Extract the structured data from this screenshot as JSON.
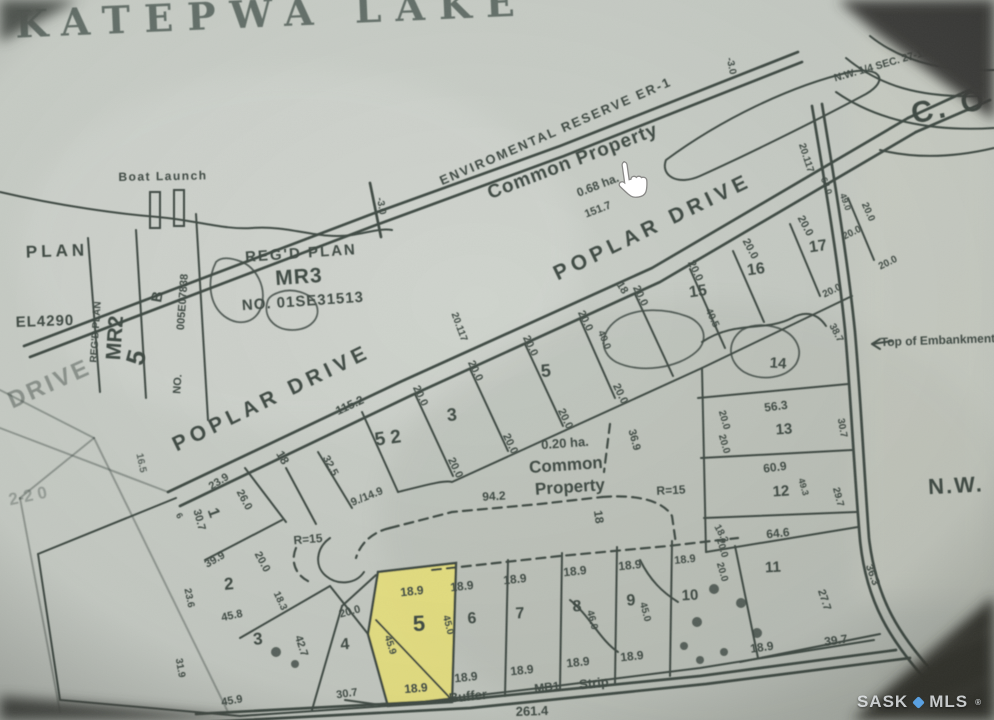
{
  "title": "KATEPWA LAKE",
  "watermark": {
    "left": "SASK",
    "right": "MLS",
    "reg": "®",
    "dot_color": "#5aa0e0"
  },
  "colors": {
    "paper_light": "#d0d5ce",
    "paper_dark": "#c2c7bf",
    "ink": "#404b45",
    "ink_faint": "#6b746d",
    "title_ink": "#4d5c54",
    "highlight_yellow": "#efe678",
    "corner_shadow": "#3b3d38",
    "cursor_fill": "#ffffff",
    "cursor_stroke": "#8a8a88"
  },
  "cursor": {
    "type": "hand-pointer",
    "x": 608,
    "y": 163
  },
  "labels": [
    {
      "t": "KATEPWA LAKE",
      "x": 272,
      "y": 17,
      "r": -2.5,
      "s": 38,
      "ls": 14,
      "f": "serif",
      "o": 0.8,
      "c": "#4d5c54"
    },
    {
      "t": "N.W. 1/4 SEC. 27-19-12-2",
      "x": 893,
      "y": 62,
      "r": -16,
      "s": 10.5
    },
    {
      "t": "C. O",
      "x": 950,
      "y": 108,
      "r": -12,
      "s": 30,
      "ls": 4
    },
    {
      "t": "-3.0",
      "x": 731,
      "y": 66,
      "r": 78,
      "s": 10
    },
    {
      "t": "20.117",
      "x": 806,
      "y": 158,
      "r": 72,
      "s": 10
    },
    {
      "t": "64.0",
      "x": 826,
      "y": 186,
      "r": 70,
      "s": 9
    },
    {
      "t": "49.0",
      "x": 845,
      "y": 202,
      "r": 70,
      "s": 9
    },
    {
      "t": "ENVIROMENTAL RESERVE ER-1",
      "x": 556,
      "y": 132,
      "r": -23.5,
      "s": 13,
      "ls": 2
    },
    {
      "t": "Common Property",
      "x": 573,
      "y": 162,
      "r": -21,
      "s": 19,
      "ls": 1
    },
    {
      "t": "0.68 ha.",
      "x": 598,
      "y": 186,
      "r": -21,
      "s": 12
    },
    {
      "t": "151.7",
      "x": 598,
      "y": 210,
      "r": -21,
      "s": 11
    },
    {
      "t": "-3.0",
      "x": 381,
      "y": 206,
      "r": 80,
      "s": 10
    },
    {
      "t": "POPLAR  DRIVE",
      "x": 272,
      "y": 399,
      "r": -26,
      "s": 21,
      "ls": 5
    },
    {
      "t": "115.2",
      "x": 350,
      "y": 406,
      "r": -25,
      "s": 12
    },
    {
      "t": "POPLAR  DRIVE",
      "x": 653,
      "y": 228,
      "r": -26,
      "s": 21,
      "ls": 5
    },
    {
      "t": "5 2",
      "x": 388,
      "y": 439,
      "r": -8,
      "s": 19
    },
    {
      "t": "3",
      "x": 452,
      "y": 416,
      "r": -5,
      "s": 18
    },
    {
      "t": "5",
      "x": 546,
      "y": 372,
      "r": -5,
      "s": 18
    },
    {
      "t": "15",
      "x": 698,
      "y": 292,
      "r": -8,
      "s": 16
    },
    {
      "t": "16",
      "x": 756,
      "y": 270,
      "r": -8,
      "s": 16
    },
    {
      "t": "17",
      "x": 818,
      "y": 247,
      "r": -8,
      "s": 16
    },
    {
      "t": "18",
      "x": 282,
      "y": 458,
      "r": 60,
      "s": 12
    },
    {
      "t": "32.5",
      "x": 330,
      "y": 466,
      "r": 62,
      "s": 11
    },
    {
      "t": "9./14.9",
      "x": 367,
      "y": 497,
      "r": -22,
      "s": 11
    },
    {
      "t": "20.117",
      "x": 459,
      "y": 327,
      "r": 70,
      "s": 10
    },
    {
      "t": "18",
      "x": 622,
      "y": 288,
      "r": 58,
      "s": 11
    },
    {
      "t": "18",
      "x": 598,
      "y": 517,
      "r": 82,
      "s": 12
    },
    {
      "t": "40.0",
      "x": 604,
      "y": 340,
      "r": 68,
      "s": 10
    },
    {
      "t": "40.5",
      "x": 712,
      "y": 318,
      "r": 65,
      "s": 10
    },
    {
      "t": "20.0",
      "x": 420,
      "y": 396,
      "r": 64,
      "s": 11
    },
    {
      "t": "20.0",
      "x": 475,
      "y": 371,
      "r": 64,
      "s": 11
    },
    {
      "t": "20.0",
      "x": 530,
      "y": 346,
      "r": 64,
      "s": 11
    },
    {
      "t": "20.0",
      "x": 585,
      "y": 321,
      "r": 64,
      "s": 11
    },
    {
      "t": "20.0",
      "x": 640,
      "y": 296,
      "r": 64,
      "s": 11
    },
    {
      "t": "20.0",
      "x": 695,
      "y": 271,
      "r": 64,
      "s": 11
    },
    {
      "t": "20.0",
      "x": 750,
      "y": 249,
      "r": 62,
      "s": 11
    },
    {
      "t": "20.0",
      "x": 805,
      "y": 226,
      "r": 62,
      "s": 11
    },
    {
      "t": "20.0",
      "x": 455,
      "y": 468,
      "r": 64,
      "s": 11
    },
    {
      "t": "20.0",
      "x": 510,
      "y": 444,
      "r": 64,
      "s": 11
    },
    {
      "t": "20.0",
      "x": 565,
      "y": 419,
      "r": 64,
      "s": 11
    },
    {
      "t": "20.0",
      "x": 620,
      "y": 394,
      "r": 64,
      "s": 11
    },
    {
      "t": "20.0",
      "x": 724,
      "y": 420,
      "r": 74,
      "s": 10
    },
    {
      "t": "20.0",
      "x": 724,
      "y": 444,
      "r": 74,
      "s": 10
    },
    {
      "t": "20.0",
      "x": 722,
      "y": 548,
      "r": 74,
      "s": 10
    },
    {
      "t": "20.0",
      "x": 722,
      "y": 572,
      "r": 74,
      "s": 10
    },
    {
      "t": "20.0",
      "x": 868,
      "y": 212,
      "r": 66,
      "s": 10
    },
    {
      "t": "20.0",
      "x": 852,
      "y": 233,
      "r": -26,
      "s": 10
    },
    {
      "t": "20.0",
      "x": 888,
      "y": 263,
      "r": -26,
      "s": 10
    },
    {
      "t": "20.0",
      "x": 832,
      "y": 291,
      "r": -26,
      "s": 10
    },
    {
      "t": "0.20 ha.",
      "x": 565,
      "y": 444,
      "r": -4,
      "s": 13
    },
    {
      "t": "Common",
      "x": 566,
      "y": 466,
      "r": -4,
      "s": 17
    },
    {
      "t": "Property",
      "x": 570,
      "y": 488,
      "r": -4,
      "s": 17
    },
    {
      "t": "94.2",
      "x": 494,
      "y": 497,
      "r": -3,
      "s": 12
    },
    {
      "t": "36.9",
      "x": 634,
      "y": 440,
      "r": 75,
      "s": 11
    },
    {
      "t": "R=15",
      "x": 671,
      "y": 491,
      "r": -3,
      "s": 12
    },
    {
      "t": "R=15",
      "x": 308,
      "y": 540,
      "r": -5,
      "s": 12
    },
    {
      "t": "14",
      "x": 778,
      "y": 364,
      "r": 4,
      "s": 15
    },
    {
      "t": "56.3",
      "x": 776,
      "y": 407,
      "r": -7,
      "s": 12
    },
    {
      "t": "13",
      "x": 784,
      "y": 430,
      "r": -4,
      "s": 15
    },
    {
      "t": "60.9",
      "x": 775,
      "y": 468,
      "r": -7,
      "s": 12
    },
    {
      "t": "12",
      "x": 781,
      "y": 492,
      "r": -4,
      "s": 15
    },
    {
      "t": "49.3",
      "x": 803,
      "y": 487,
      "r": 74,
      "s": 9
    },
    {
      "t": "64.6",
      "x": 778,
      "y": 534,
      "r": -6,
      "s": 12
    },
    {
      "t": "30.7",
      "x": 842,
      "y": 428,
      "r": 80,
      "s": 10
    },
    {
      "t": "38.7",
      "x": 836,
      "y": 333,
      "r": 62,
      "s": 10
    },
    {
      "t": "Top of Embankment",
      "x": 938,
      "y": 341,
      "r": -2,
      "s": 12
    },
    {
      "t": "N.W.",
      "x": 956,
      "y": 487,
      "r": -3,
      "s": 22,
      "ls": 2
    },
    {
      "t": "29.7",
      "x": 838,
      "y": 497,
      "r": 75,
      "s": 10
    },
    {
      "t": "27.7",
      "x": 824,
      "y": 600,
      "r": 72,
      "s": 11
    },
    {
      "t": "36.3",
      "x": 872,
      "y": 575,
      "r": 70,
      "s": 11
    },
    {
      "t": "18.3",
      "x": 721,
      "y": 534,
      "r": 62,
      "s": 10
    },
    {
      "t": "1",
      "x": 213,
      "y": 513,
      "r": 70,
      "s": 16
    },
    {
      "t": "23.9",
      "x": 219,
      "y": 482,
      "r": -32,
      "s": 11
    },
    {
      "t": "26.0",
      "x": 244,
      "y": 500,
      "r": 62,
      "s": 11
    },
    {
      "t": "30.7",
      "x": 199,
      "y": 520,
      "r": 75,
      "s": 11
    },
    {
      "t": "6",
      "x": 179,
      "y": 516,
      "r": 60,
      "s": 9
    },
    {
      "t": "39.9",
      "x": 215,
      "y": 560,
      "r": -30,
      "s": 11
    },
    {
      "t": "20.0",
      "x": 262,
      "y": 562,
      "r": 62,
      "s": 11
    },
    {
      "t": "2",
      "x": 229,
      "y": 585,
      "r": -5,
      "s": 17
    },
    {
      "t": "23.6",
      "x": 189,
      "y": 598,
      "r": 78,
      "s": 10
    },
    {
      "t": "45.8",
      "x": 232,
      "y": 616,
      "r": -12,
      "s": 11
    },
    {
      "t": "18.3",
      "x": 280,
      "y": 601,
      "r": 65,
      "s": 10
    },
    {
      "t": "3",
      "x": 258,
      "y": 640,
      "r": -5,
      "s": 17
    },
    {
      "t": "31.9",
      "x": 180,
      "y": 668,
      "r": 80,
      "s": 10
    },
    {
      "t": "42.7",
      "x": 301,
      "y": 646,
      "r": 72,
      "s": 11
    },
    {
      "t": "45.9",
      "x": 232,
      "y": 701,
      "r": -10,
      "s": 11
    },
    {
      "t": "4",
      "x": 345,
      "y": 645,
      "r": -5,
      "s": 16
    },
    {
      "t": "20.0",
      "x": 350,
      "y": 612,
      "r": -15,
      "s": 11
    },
    {
      "t": "30.7",
      "x": 347,
      "y": 694,
      "r": -8,
      "s": 11
    },
    {
      "t": "18.9",
      "x": 412,
      "y": 592,
      "r": -6,
      "s": 12
    },
    {
      "t": "5",
      "x": 419,
      "y": 625,
      "r": -3,
      "s": 22
    },
    {
      "t": "45.9",
      "x": 390,
      "y": 645,
      "r": 72,
      "s": 10
    },
    {
      "t": "18.9",
      "x": 416,
      "y": 689,
      "r": -5,
      "s": 12
    },
    {
      "t": "18.9",
      "x": 462,
      "y": 587,
      "r": -6,
      "s": 12
    },
    {
      "t": "45.0",
      "x": 448,
      "y": 625,
      "r": 75,
      "s": 10
    },
    {
      "t": "6",
      "x": 472,
      "y": 619,
      "r": -3,
      "s": 16
    },
    {
      "t": "18.9",
      "x": 466,
      "y": 678,
      "r": -6,
      "s": 12
    },
    {
      "t": "18.9",
      "x": 515,
      "y": 580,
      "r": -6,
      "s": 12
    },
    {
      "t": "7",
      "x": 520,
      "y": 614,
      "r": -3,
      "s": 16
    },
    {
      "t": "18.9",
      "x": 522,
      "y": 671,
      "r": -6,
      "s": 12
    },
    {
      "t": "18.9",
      "x": 575,
      "y": 572,
      "r": -6,
      "s": 12
    },
    {
      "t": "8",
      "x": 577,
      "y": 607,
      "r": -3,
      "s": 16
    },
    {
      "t": "46.0",
      "x": 592,
      "y": 620,
      "r": 75,
      "s": 10
    },
    {
      "t": "18.9",
      "x": 578,
      "y": 663,
      "r": -6,
      "s": 12
    },
    {
      "t": "18.9",
      "x": 630,
      "y": 566,
      "r": -6,
      "s": 12
    },
    {
      "t": "9",
      "x": 631,
      "y": 601,
      "r": -3,
      "s": 16
    },
    {
      "t": "45.0",
      "x": 645,
      "y": 612,
      "r": 75,
      "s": 10
    },
    {
      "t": "18.9",
      "x": 632,
      "y": 657,
      "r": -6,
      "s": 12
    },
    {
      "t": "18.9",
      "x": 685,
      "y": 560,
      "r": -6,
      "s": 11
    },
    {
      "t": "10",
      "x": 690,
      "y": 596,
      "r": -3,
      "s": 15
    },
    {
      "t": "18.9",
      "x": 762,
      "y": 648,
      "r": -8,
      "s": 12
    },
    {
      "t": "11",
      "x": 773,
      "y": 568,
      "r": -3,
      "s": 15
    },
    {
      "t": "39.7",
      "x": 836,
      "y": 641,
      "r": -8,
      "s": 12
    },
    {
      "t": "Buffer",
      "x": 468,
      "y": 697,
      "r": -6,
      "s": 13
    },
    {
      "t": "MB1",
      "x": 547,
      "y": 688,
      "r": -6,
      "s": 12
    },
    {
      "t": "Strip",
      "x": 594,
      "y": 684,
      "r": -6,
      "s": 13
    },
    {
      "t": "261.4",
      "x": 532,
      "y": 712,
      "r": -2,
      "s": 13
    },
    {
      "t": "Boat Launch",
      "x": 163,
      "y": 177,
      "r": -1,
      "s": 12,
      "ls": 1.5
    },
    {
      "t": "PLAN",
      "x": 57,
      "y": 252,
      "r": -2,
      "s": 17,
      "ls": 4
    },
    {
      "t": "EL4290",
      "x": 45,
      "y": 322,
      "r": -2,
      "s": 15,
      "ls": 1
    },
    {
      "t": "REG'D PLAN",
      "x": 96,
      "y": 332,
      "r": -86,
      "s": 10
    },
    {
      "t": "MR2",
      "x": 116,
      "y": 338,
      "r": -86,
      "s": 21
    },
    {
      "t": "B",
      "x": 158,
      "y": 297,
      "r": -80,
      "s": 15
    },
    {
      "t": "005E07838",
      "x": 183,
      "y": 302,
      "r": -86,
      "s": 11
    },
    {
      "t": "NO.",
      "x": 178,
      "y": 384,
      "r": -86,
      "s": 11
    },
    {
      "t": "5",
      "x": 138,
      "y": 358,
      "r": -75,
      "s": 26
    },
    {
      "t": "REG'D PLAN",
      "x": 301,
      "y": 254,
      "r": -4,
      "s": 15,
      "ls": 2
    },
    {
      "t": "MR3",
      "x": 299,
      "y": 278,
      "r": -4,
      "s": 21,
      "ls": 1
    },
    {
      "t": "NO. 01SE31513",
      "x": 303,
      "y": 302,
      "r": -4,
      "s": 15,
      "ls": 1
    },
    {
      "t": "DRIVE",
      "x": 50,
      "y": 385,
      "r": -24,
      "s": 24,
      "ls": 3,
      "o": 0.45
    },
    {
      "t": "2-2 0",
      "x": 28,
      "y": 497,
      "r": -12,
      "s": 17,
      "o": 0.35
    },
    {
      "t": "16.5",
      "x": 141,
      "y": 463,
      "r": 78,
      "s": 10,
      "o": 0.8
    }
  ],
  "geometry": {
    "bold": [
      "M168,492 L400,382 L652,268 L908,118",
      "M180,506 L410,396 L660,282 L916,132",
      "M908,118 L982,84",
      "M916,132 L990,100",
      "M24,346 L372,214 L560,146 L798,52",
      "M30,357 L376,225 L564,156 L802,62",
      "M370,183 L381,237",
      "M196,714 L460,700 L700,676 L896,650",
      "M208,722 L470,708 L706,684 L910,658",
      "M812,106 C826,190 838,260 845,330 C851,400 854,470 860,540 C866,600 888,640 935,690",
      "M822,104 C836,190 848,262 855,332 C861,402 864,470 869,538 C876,598 898,636 944,684"
    ],
    "solid": [
      "M0,192 C60,206 120,214 158,217 C200,221 225,230 252,228 C290,225 318,240 352,235 C370,232 382,228 392,230",
      "M846,58 C880,86 920,98 980,96",
      "M836,92 C876,120 930,132 994,128",
      "M666,160 C720,120 790,86 850,72 C880,66 890,80 866,94 C810,124 740,158 700,176 C678,186 660,176 666,160",
      "M870,36 C900,60 940,72 994,70",
      "M880,150 C920,160 960,156 994,148",
      "M88,238 L100,392",
      "M136,230 L146,398",
      "M196,214 L208,420",
      "M362,412 L398,492",
      "M415,394 L453,476",
      "M470,369 L508,451",
      "M525,344 L563,426",
      "M580,319 L615,398",
      "M635,294 L673,376",
      "M690,269 L725,348",
      "M733,251 L764,322",
      "M790,224 L820,296",
      "M848,198 L874,260",
      "M318,452 L352,508",
      "M286,468 L316,524",
      "M398,492 C430,484 445,480 452,482 L702,368",
      "M702,368 L852,296",
      "M698,398 L848,384",
      "M701,458 L852,450",
      "M704,518 L856,512",
      "M706,552 L858,527",
      "M702,368 L706,552",
      "M735,546 L758,658",
      "M740,662 L880,634",
      "M508,560 L505,696",
      "M562,553 L560,690",
      "M617,547 L615,683",
      "M672,541 L670,676",
      "M386,706 L540,688 L700,668 L874,640",
      "M38,554 L176,498",
      "M38,554 L60,700",
      "M60,700 L240,716",
      "M240,716 L386,706",
      "M245,468 L286,522",
      "M205,560 L282,520",
      "M240,638 L330,586",
      "M312,710 L342,606",
      "M342,606 L376,575",
      "M330,586 L368,634",
      "M345,700 L388,706",
      "M330,538 C316,548 314,566 326,576 C338,586 356,584 364,572",
      "M376,620 L452,700",
      "M702,342 C735,320 765,332 792,318 C806,310 818,314 826,326",
      "M570,600 C590,616 600,640 618,652",
      "M640,560 C650,580 662,592 678,602",
      "M872,344 L892,341",
      "M872,344 L880,339",
      "M872,344 L880,349"
    ],
    "dashed": [
      "M390,528 L452,512 L540,504 L602,497",
      "M602,497 C640,494 664,502 672,516 L676,544",
      "M610,424 L604,472",
      "M390,528 C372,532 360,544 356,558",
      "M432,570 L560,556 L668,546 L738,538",
      "M296,548 C290,562 296,576 310,582"
    ],
    "faint": [
      "M0,390 L94,438",
      "M94,438 L228,712",
      "M94,438 L20,498",
      "M20,498 L60,712",
      "M0,428 L168,492"
    ],
    "ponds": [
      "M216,262 C206,282 210,305 224,316 C240,328 258,322 262,304 C266,286 256,268 242,262 C232,258 222,256 216,262",
      "M268,300 C262,316 274,330 292,330 C310,330 322,318 316,304 C310,292 292,288 280,292 C274,294 270,296 268,300",
      "M620,318 C600,330 598,352 616,362 C640,374 678,368 696,352 C710,340 704,322 686,316 C664,308 638,308 620,318",
      "M742,330 C726,342 728,362 744,372 C762,382 786,378 796,364 C804,350 796,334 778,328 C765,324 752,324 742,330"
    ],
    "yellow_lot": "378,572 456,563 452,702 388,706 368,634",
    "piers": [
      [
        150,
        192,
        10,
        36
      ],
      [
        174,
        190,
        10,
        36
      ]
    ],
    "trees": [
      [
        697,
        622,
        5
      ],
      [
        714,
        589,
        5
      ],
      [
        741,
        603,
        5
      ],
      [
        757,
        633,
        5
      ],
      [
        684,
        646,
        4
      ],
      [
        724,
        652,
        4
      ],
      [
        700,
        660,
        4
      ],
      [
        276,
        652,
        5
      ],
      [
        295,
        664,
        4
      ]
    ]
  }
}
